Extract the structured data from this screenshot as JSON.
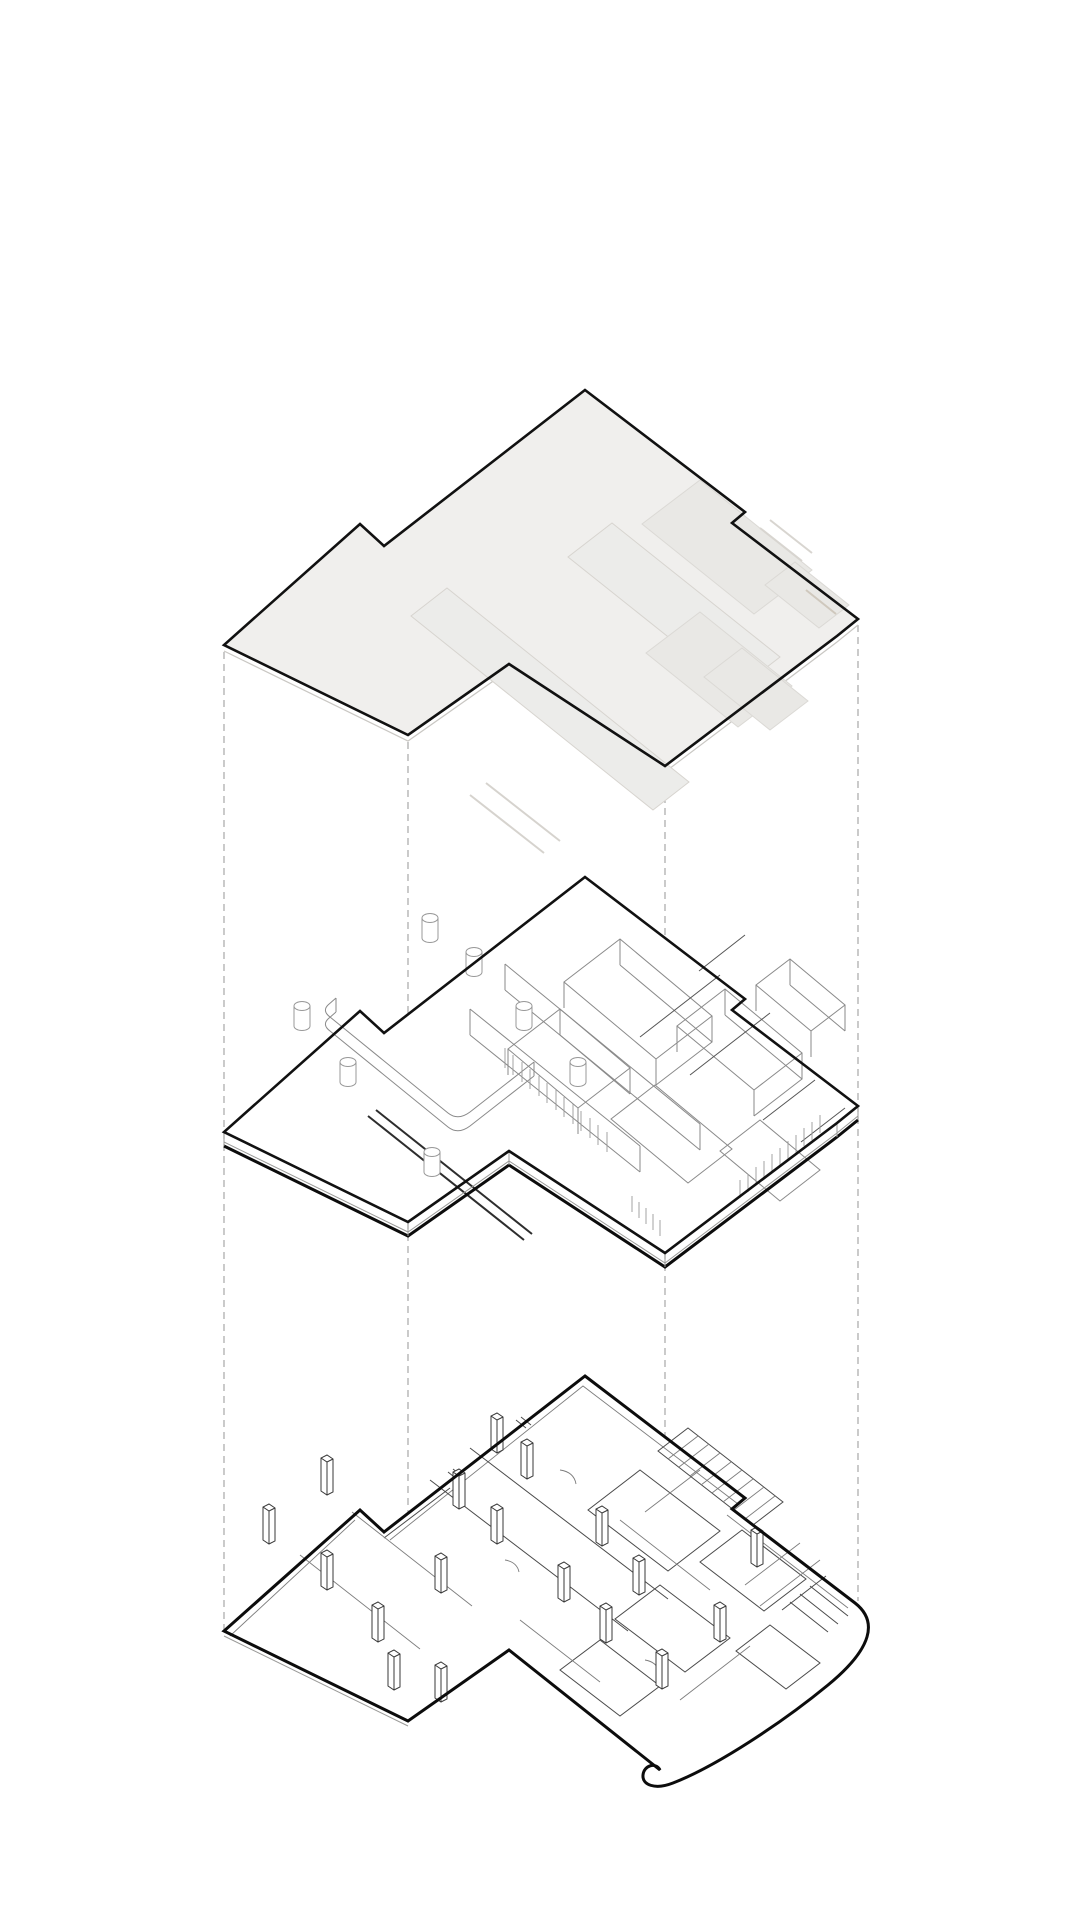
{
  "diagram": {
    "title": "exploded-axonometric-building-diagram",
    "background_color": "#ffffff",
    "ink_color": "#111111",
    "guide_color": "#a8a8a8",
    "roof_fill_color": "#f0efed",
    "ghost_fill_color": "#e9e8e5",
    "layers": [
      {
        "id": "roof",
        "label": "Roof slab plate with ghosted rooftop steps"
      },
      {
        "id": "middle",
        "label": "Upper level with interior walls, round columns and louver screens"
      },
      {
        "id": "bottom",
        "label": "Ground floor plan with structural columns and service core"
      }
    ],
    "guides": {
      "count": 4,
      "x_positions": [
        224,
        408,
        665,
        858
      ],
      "style": "dashed vertical projection lines linking layer corners"
    },
    "counts": {
      "round_columns_middle": 7,
      "rect_columns_bottom": 18
    }
  }
}
